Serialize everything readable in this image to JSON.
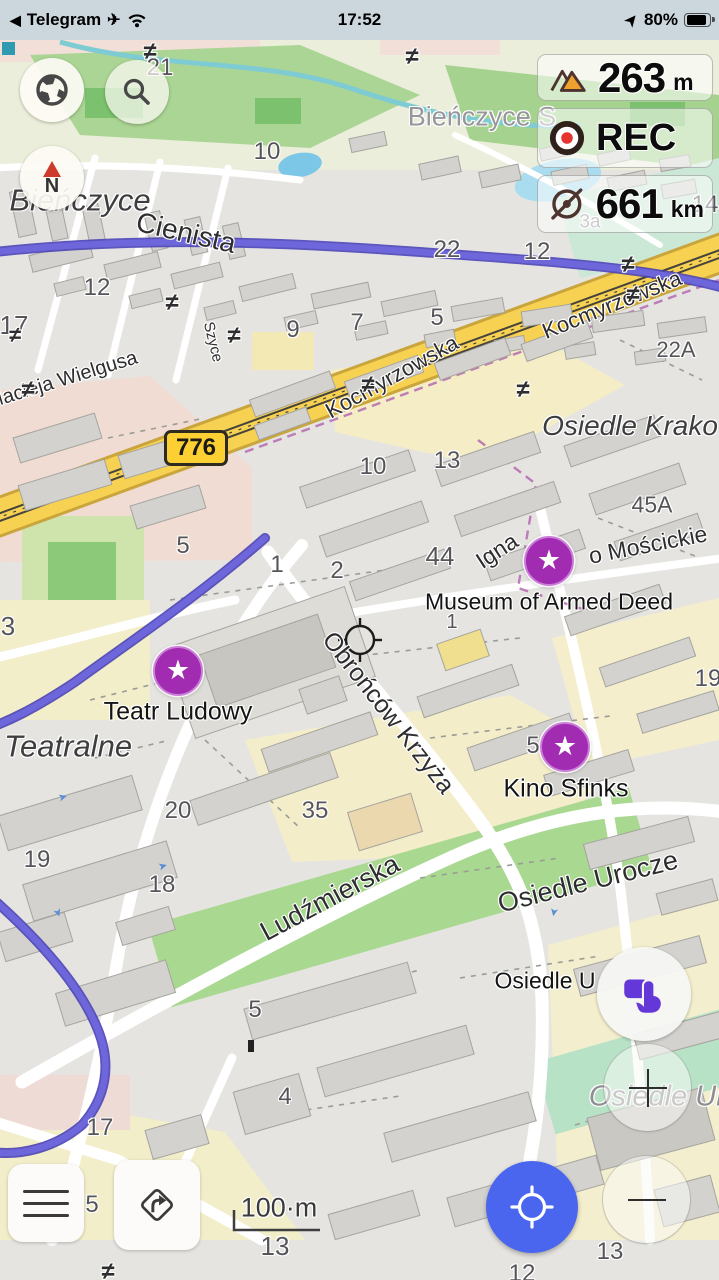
{
  "status_bar": {
    "back_glyph": "◀",
    "app": "Telegram",
    "plane_glyph": "✈",
    "time": "17:52",
    "nav_glyph": "➤",
    "battery_pct": "80%"
  },
  "controls": {
    "compass_letter": "N",
    "route_badge": "776"
  },
  "widgets": {
    "altitude": {
      "value": "263",
      "unit": "m"
    },
    "recording": {
      "label": "REC"
    },
    "radius_ruler": {
      "value": "661",
      "unit": "km"
    }
  },
  "colors": {
    "accent_blue": "#4b66ee",
    "poi_purple": "#a12cb1",
    "route_purple": "#6e66db",
    "road_yellow": "#f7d152",
    "status_bg": "#ccd6dd"
  },
  "markers": [
    {
      "id": "museum-of-armed-deed",
      "x": 549,
      "y": 561
    },
    {
      "id": "teatr-ludowy",
      "x": 178,
      "y": 671
    },
    {
      "id": "kino-sfinks",
      "x": 565,
      "y": 747
    }
  ],
  "map_labels": [
    {
      "t": "Bieńczyce",
      "x": 80,
      "y": 200,
      "r": 0,
      "s": 31,
      "c": "place"
    },
    {
      "t": "Bieńczyce S",
      "x": 482,
      "y": 117,
      "r": 0,
      "s": 27,
      "c": "place-dim"
    },
    {
      "t": "Cienista",
      "x": 186,
      "y": 233,
      "r": 13,
      "s": 28,
      "c": "street"
    },
    {
      "t": "Kocmyrzowska",
      "x": 392,
      "y": 377,
      "r": -29,
      "s": 22,
      "c": "street"
    },
    {
      "t": "Kocmyrzowska",
      "x": 612,
      "y": 305,
      "r": -22,
      "s": 22,
      "c": "street"
    },
    {
      "t": "Macieja Wielgusa",
      "x": 62,
      "y": 380,
      "r": -17,
      "s": 20,
      "c": "street"
    },
    {
      "t": "Szyce",
      "x": 213,
      "y": 342,
      "r": 76,
      "s": 15,
      "c": "street"
    },
    {
      "t": "Osiedle Krako",
      "x": 630,
      "y": 426,
      "r": 0,
      "s": 28,
      "c": "place"
    },
    {
      "t": "Igna",
      "x": 497,
      "y": 551,
      "r": -33,
      "s": 23,
      "c": "street"
    },
    {
      "t": "o Mościckie",
      "x": 648,
      "y": 545,
      "r": -11,
      "s": 23,
      "c": "street"
    },
    {
      "t": "Museum of Armed Deed",
      "x": 549,
      "y": 602,
      "r": 0,
      "s": 23,
      "c": "poi"
    },
    {
      "t": "Teatr Ludowy",
      "x": 178,
      "y": 712,
      "r": 0,
      "s": 25,
      "c": "poi"
    },
    {
      "t": "Teatralne",
      "x": 68,
      "y": 746,
      "r": 0,
      "s": 31,
      "c": "place"
    },
    {
      "t": "Obrońców Krzyża",
      "x": 388,
      "y": 713,
      "r": 52,
      "s": 25,
      "c": "street"
    },
    {
      "t": "Kino Sfinks",
      "x": 566,
      "y": 789,
      "r": 0,
      "s": 25,
      "c": "poi"
    },
    {
      "t": "Ludźmierska",
      "x": 330,
      "y": 898,
      "r": -28,
      "s": 27,
      "c": "street"
    },
    {
      "t": "Osiedle Urocze",
      "x": 588,
      "y": 882,
      "r": -14,
      "s": 27,
      "c": "street"
    },
    {
      "t": "Osiedle U",
      "x": 545,
      "y": 981,
      "r": 0,
      "s": 23,
      "c": "poi"
    },
    {
      "t": "Osiedle Urocze",
      "x": 688,
      "y": 1097,
      "r": 0,
      "s": 29,
      "c": "place-dim-i"
    },
    {
      "t": "100·m",
      "x": 279,
      "y": 1208,
      "r": 0,
      "s": 27,
      "c": "scale"
    },
    {
      "t": "21",
      "x": 160,
      "y": 68,
      "r": 0,
      "s": 24,
      "c": "num"
    },
    {
      "t": "10",
      "x": 267,
      "y": 152,
      "r": 0,
      "s": 24,
      "c": "num"
    },
    {
      "t": "12",
      "x": 97,
      "y": 288,
      "r": 0,
      "s": 24,
      "c": "num"
    },
    {
      "t": "22",
      "x": 447,
      "y": 250,
      "r": 0,
      "s": 24,
      "c": "num"
    },
    {
      "t": "12",
      "x": 537,
      "y": 252,
      "r": 0,
      "s": 24,
      "c": "num"
    },
    {
      "t": "14",
      "x": 705,
      "y": 205,
      "r": 0,
      "s": 24,
      "c": "num"
    },
    {
      "t": "3a",
      "x": 590,
      "y": 222,
      "r": 0,
      "s": 19,
      "c": "num-dim"
    },
    {
      "t": "17",
      "x": 14,
      "y": 325,
      "r": 0,
      "s": 26,
      "c": "num"
    },
    {
      "t": "9",
      "x": 293,
      "y": 330,
      "r": 0,
      "s": 24,
      "c": "num"
    },
    {
      "t": "7",
      "x": 357,
      "y": 323,
      "r": 0,
      "s": 24,
      "c": "num"
    },
    {
      "t": "5",
      "x": 437,
      "y": 318,
      "r": 0,
      "s": 24,
      "c": "num"
    },
    {
      "t": "22A",
      "x": 676,
      "y": 350,
      "r": 0,
      "s": 22,
      "c": "num"
    },
    {
      "t": "10",
      "x": 373,
      "y": 467,
      "r": 0,
      "s": 24,
      "c": "num"
    },
    {
      "t": "13",
      "x": 447,
      "y": 461,
      "r": 0,
      "s": 24,
      "c": "num"
    },
    {
      "t": "45A",
      "x": 652,
      "y": 505,
      "r": 0,
      "s": 23,
      "c": "num"
    },
    {
      "t": "5",
      "x": 183,
      "y": 546,
      "r": 0,
      "s": 24,
      "c": "num"
    },
    {
      "t": "1",
      "x": 277,
      "y": 565,
      "r": 0,
      "s": 24,
      "c": "num"
    },
    {
      "t": "2",
      "x": 337,
      "y": 571,
      "r": 0,
      "s": 24,
      "c": "num"
    },
    {
      "t": "44",
      "x": 440,
      "y": 556,
      "r": 0,
      "s": 26,
      "c": "num"
    },
    {
      "t": "1",
      "x": 452,
      "y": 622,
      "r": 0,
      "s": 20,
      "c": "num"
    },
    {
      "t": "3",
      "x": 8,
      "y": 626,
      "r": 0,
      "s": 26,
      "c": "num"
    },
    {
      "t": "19",
      "x": 708,
      "y": 679,
      "r": 0,
      "s": 24,
      "c": "num"
    },
    {
      "t": "5",
      "x": 533,
      "y": 746,
      "r": 0,
      "s": 24,
      "c": "num"
    },
    {
      "t": "20",
      "x": 178,
      "y": 811,
      "r": 0,
      "s": 24,
      "c": "num"
    },
    {
      "t": "35",
      "x": 315,
      "y": 811,
      "r": 0,
      "s": 24,
      "c": "num"
    },
    {
      "t": "19",
      "x": 37,
      "y": 860,
      "r": 0,
      "s": 24,
      "c": "num"
    },
    {
      "t": "18",
      "x": 162,
      "y": 885,
      "r": 0,
      "s": 24,
      "c": "num"
    },
    {
      "t": "5",
      "x": 255,
      "y": 1010,
      "r": 0,
      "s": 24,
      "c": "num"
    },
    {
      "t": "4",
      "x": 285,
      "y": 1097,
      "r": 0,
      "s": 24,
      "c": "num"
    },
    {
      "t": "17",
      "x": 100,
      "y": 1128,
      "r": 0,
      "s": 24,
      "c": "num"
    },
    {
      "t": "5",
      "x": 92,
      "y": 1205,
      "r": 0,
      "s": 24,
      "c": "num"
    },
    {
      "t": "13",
      "x": 275,
      "y": 1246,
      "r": 0,
      "s": 26,
      "c": "num"
    },
    {
      "t": "13",
      "x": 610,
      "y": 1252,
      "r": 0,
      "s": 24,
      "c": "num"
    },
    {
      "t": "12",
      "x": 522,
      "y": 1274,
      "r": 0,
      "s": 24,
      "c": "num"
    },
    {
      "t": "≠",
      "x": 150,
      "y": 52,
      "r": 0,
      "s": 24,
      "c": "sym"
    },
    {
      "t": "≠",
      "x": 412,
      "y": 57,
      "r": 0,
      "s": 24,
      "c": "sym"
    },
    {
      "t": "≠",
      "x": 172,
      "y": 303,
      "r": 0,
      "s": 24,
      "c": "sym"
    },
    {
      "t": "≠",
      "x": 234,
      "y": 336,
      "r": 0,
      "s": 24,
      "c": "sym"
    },
    {
      "t": "≠",
      "x": 28,
      "y": 390,
      "r": 0,
      "s": 24,
      "c": "sym"
    },
    {
      "t": "≠",
      "x": 15,
      "y": 335,
      "r": 0,
      "s": 22,
      "c": "sym"
    },
    {
      "t": "≠",
      "x": 368,
      "y": 385,
      "r": 0,
      "s": 24,
      "c": "sym"
    },
    {
      "t": "≠",
      "x": 523,
      "y": 390,
      "r": 0,
      "s": 24,
      "c": "sym"
    },
    {
      "t": "≠",
      "x": 628,
      "y": 265,
      "r": 0,
      "s": 24,
      "c": "sym"
    },
    {
      "t": "≠",
      "x": 633,
      "y": 295,
      "r": 0,
      "s": 24,
      "c": "sym"
    },
    {
      "t": "≠",
      "x": 108,
      "y": 1272,
      "r": 0,
      "s": 24,
      "c": "sym"
    },
    {
      "t": "➤",
      "x": 63,
      "y": 798,
      "r": -15,
      "s": 11,
      "c": "arrow"
    },
    {
      "t": "➤",
      "x": 163,
      "y": 867,
      "r": -15,
      "s": 11,
      "c": "arrow"
    },
    {
      "t": "➤",
      "x": 553,
      "y": 912,
      "r": 100,
      "s": 11,
      "c": "arrow"
    },
    {
      "t": "➤",
      "x": 57,
      "y": 913,
      "r": 70,
      "s": 11,
      "c": "arrow"
    }
  ]
}
